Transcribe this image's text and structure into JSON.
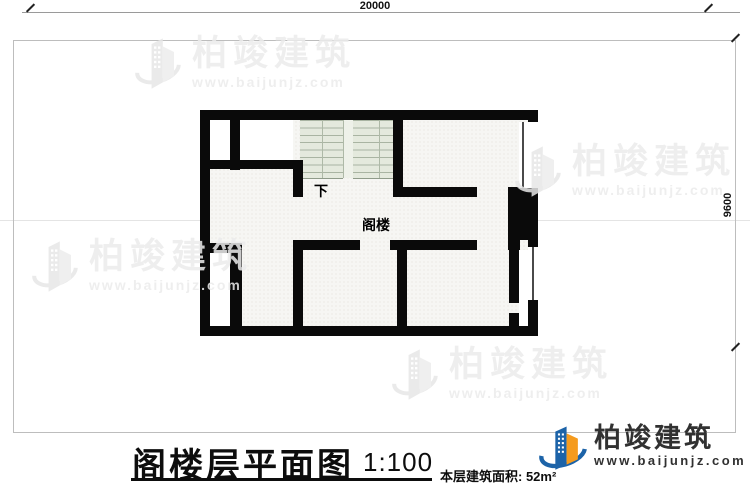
{
  "dimensions": {
    "top": "20000",
    "right": "9600"
  },
  "plan": {
    "labels": [
      {
        "name": "down-label",
        "text": "下",
        "x": 114,
        "y": 71,
        "size": 14
      },
      {
        "name": "attic-label",
        "text": "阁楼",
        "x": 162,
        "y": 105,
        "size": 14
      }
    ],
    "walls": [
      [
        0,
        0,
        338,
        10
      ],
      [
        0,
        0,
        10,
        226
      ],
      [
        0,
        216,
        338,
        10
      ],
      [
        328,
        0,
        10,
        226
      ],
      [
        30,
        10,
        10,
        50
      ],
      [
        0,
        50,
        103,
        9
      ],
      [
        93,
        50,
        10,
        37
      ],
      [
        193,
        0,
        10,
        87
      ],
      [
        193,
        77,
        84,
        10
      ],
      [
        308,
        77,
        30,
        53
      ],
      [
        10,
        133,
        32,
        10
      ],
      [
        30,
        133,
        12,
        93
      ],
      [
        93,
        130,
        67,
        10
      ],
      [
        93,
        130,
        10,
        96
      ],
      [
        190,
        130,
        87,
        10
      ],
      [
        197,
        130,
        10,
        96
      ],
      [
        308,
        130,
        12,
        10
      ],
      [
        309,
        130,
        10,
        63
      ],
      [
        309,
        203,
        10,
        13
      ]
    ],
    "white_rooms": [
      [
        10,
        10,
        20,
        40
      ],
      [
        40,
        10,
        53,
        40
      ],
      [
        10,
        143,
        20,
        73
      ],
      [
        319,
        140,
        9,
        76
      ],
      [
        328,
        198,
        10,
        10
      ]
    ],
    "windows": [
      {
        "x": 319,
        "y": 12,
        "w": 19,
        "h": 66,
        "line_at": 3
      },
      {
        "x": 328,
        "y": 137,
        "w": 10,
        "h": 53,
        "line_at": 4
      }
    ]
  },
  "titleblock": {
    "title": "阁楼层平面图",
    "scale": "1:100",
    "area": "本层建筑面积: 52m²"
  },
  "logo": {
    "name": "柏竣建筑",
    "url": "www.baijunjz.com"
  },
  "watermark": {
    "name": "柏竣建筑",
    "url": "www.baijunjz.com",
    "positions": [
      {
        "x": 134,
        "y": 34
      },
      {
        "x": 514,
        "y": 142
      },
      {
        "x": 31,
        "y": 237
      },
      {
        "x": 391,
        "y": 345
      }
    ]
  },
  "colors": {
    "wall": "#0a0a0a",
    "stair_tread": "#a9b4a2",
    "stair_bg": "#e4e9dd",
    "watermark": "#ececec",
    "logo_blue": "#1c63a8",
    "logo_orange": "#f59b1e"
  }
}
